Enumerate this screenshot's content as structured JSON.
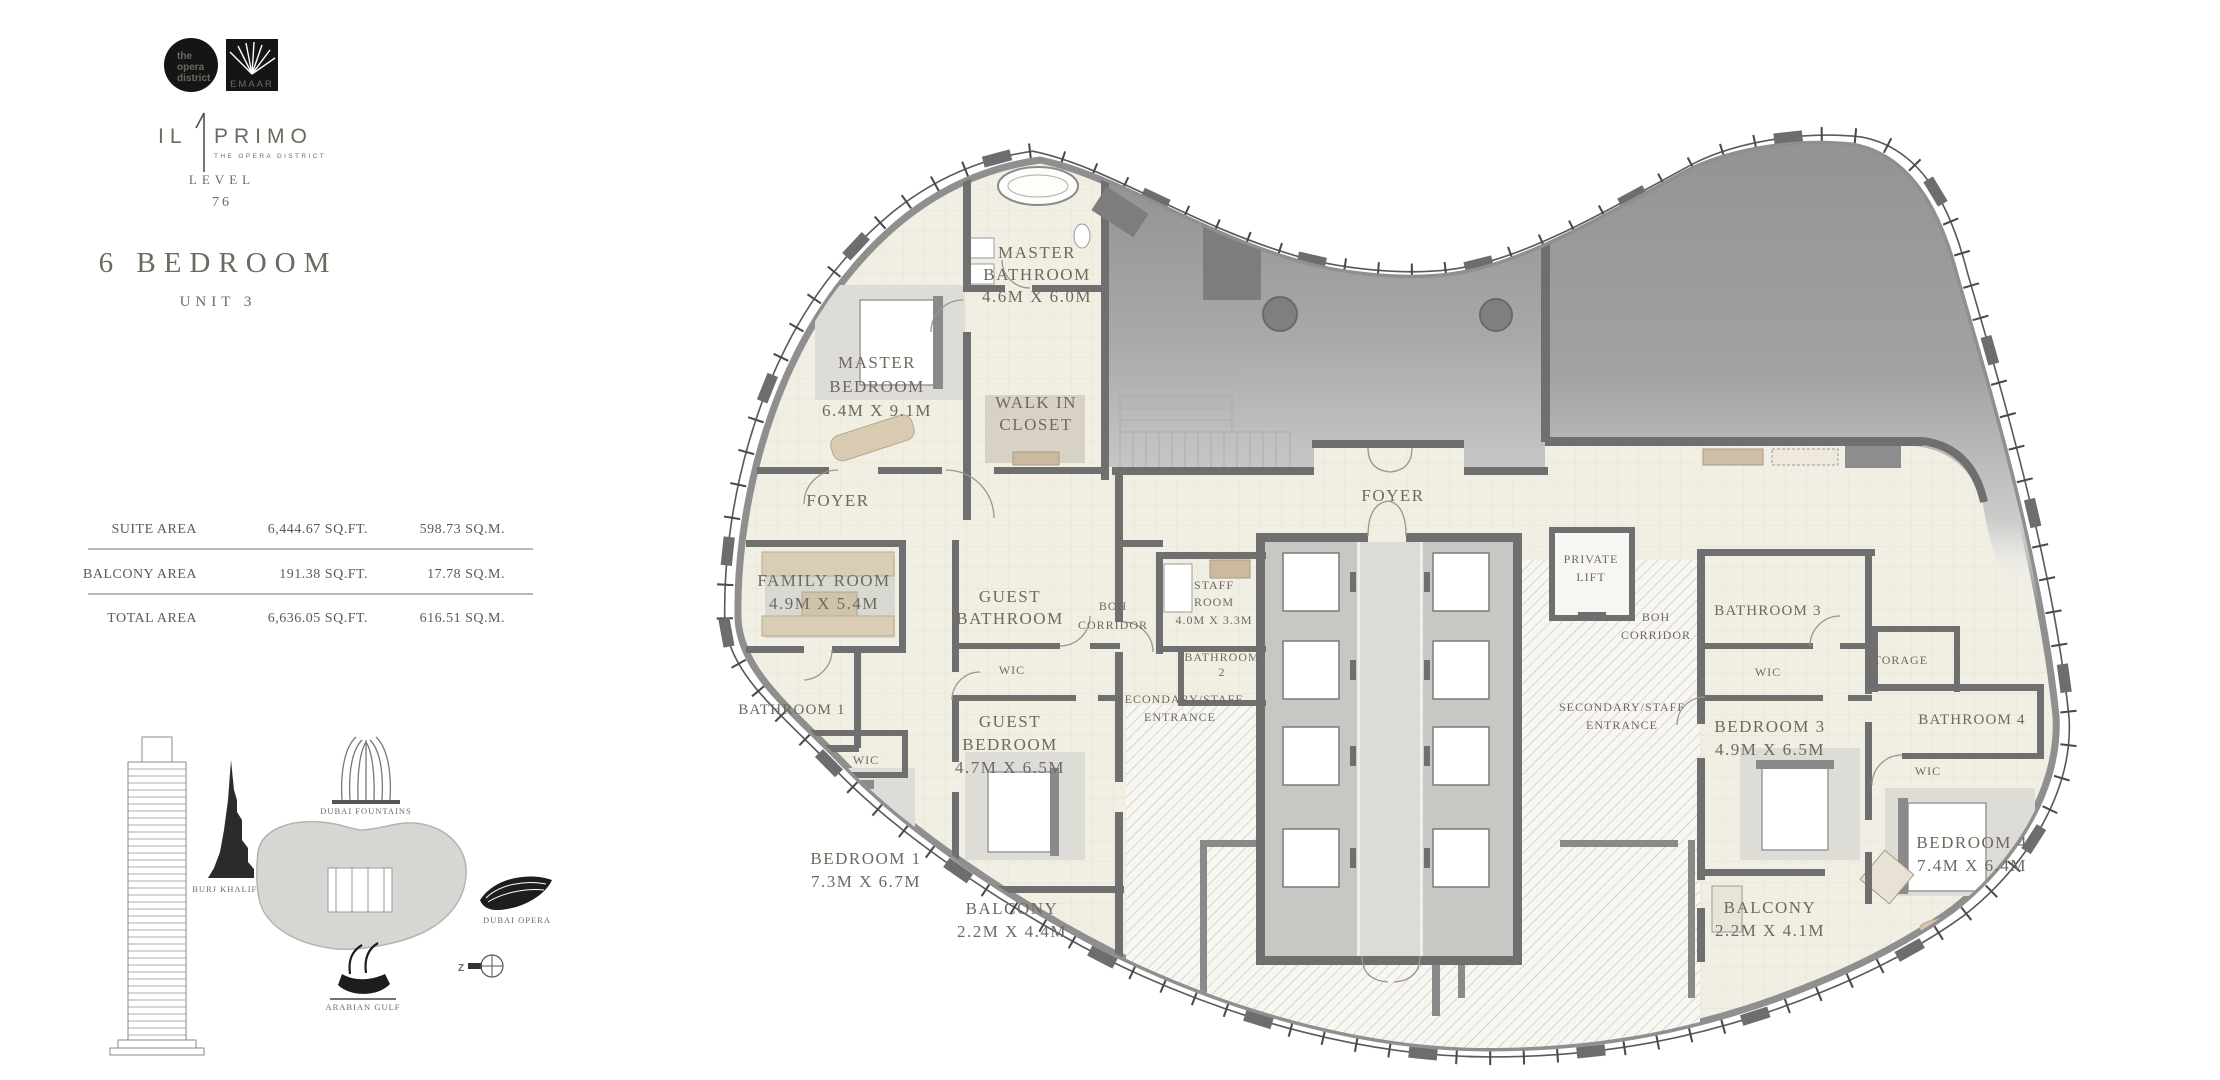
{
  "sidebar": {
    "logos": {
      "opera_district": [
        "the",
        "opera",
        "district"
      ],
      "emaar": "EMAAR"
    },
    "brand": {
      "il": "IL",
      "one": "1",
      "primo": "PRIMO",
      "subtitle": "THE OPERA DISTRICT"
    },
    "level": {
      "label": "LEVEL",
      "value": "76"
    },
    "unit": {
      "type": "6 BEDROOM",
      "number": "UNIT 3"
    },
    "area_table": {
      "rows": [
        {
          "label": "SUITE AREA",
          "sqft": "6,444.67 SQ.FT.",
          "sqm": "598.73 SQ.M."
        },
        {
          "label": "BALCONY AREA",
          "sqft": "191.38 SQ.FT.",
          "sqm": "17.78 SQ.M."
        },
        {
          "label": "TOTAL AREA",
          "sqft": "6,636.05 SQ.FT.",
          "sqm": "616.51 SQ.M."
        }
      ]
    },
    "landmarks": {
      "burj": "BURJ KHALIFA",
      "fountains": "DUBAI FOUNTAINS",
      "opera": "DUBAI OPERA",
      "gulf": "ARABIAN GULF",
      "compass": "Z"
    }
  },
  "floor_plan": {
    "rooms": [
      {
        "lines": [
          "MASTER",
          "BATHROOM",
          "4.6M X 6.0M"
        ]
      },
      {
        "lines": [
          "MASTER",
          "BEDROOM",
          "6.4M X 9.1M"
        ]
      },
      {
        "lines": [
          "WALK IN",
          "CLOSET"
        ]
      },
      {
        "lines": [
          "FOYER"
        ]
      },
      {
        "lines": [
          "FAMILY ROOM",
          "4.9M X 5.4M"
        ]
      },
      {
        "lines": [
          "GUEST",
          "BATHROOM"
        ]
      },
      {
        "lines": [
          "BOH",
          "CORRIDOR"
        ]
      },
      {
        "lines": [
          "BATHROOM 1"
        ]
      },
      {
        "lines": [
          "WIC"
        ]
      },
      {
        "lines": [
          "GUEST",
          "BEDROOM",
          "4.7M X 6.5M"
        ]
      },
      {
        "lines": [
          "WIC"
        ]
      },
      {
        "lines": [
          "BEDROOM 1",
          "7.3M X 6.7M"
        ]
      },
      {
        "lines": [
          "BALCONY",
          "2.2M X 4.4M"
        ]
      },
      {
        "lines": [
          "STAFF",
          "ROOM",
          "4.0M X 3.3M"
        ]
      },
      {
        "lines": [
          "BATHROOM",
          "2"
        ]
      },
      {
        "lines": [
          "SECONDARY/STAFF",
          "ENTRANCE"
        ]
      },
      {
        "lines": [
          "FOYER"
        ]
      },
      {
        "lines": [
          "PRIVATE",
          "LIFT"
        ]
      },
      {
        "lines": [
          "BOH",
          "CORRIDOR"
        ]
      },
      {
        "lines": [
          "SECONDARY/STAFF",
          "ENTRANCE"
        ]
      },
      {
        "lines": [
          "BATHROOM 3"
        ]
      },
      {
        "lines": [
          "WIC"
        ]
      },
      {
        "lines": [
          "STORAGE"
        ]
      },
      {
        "lines": [
          "BEDROOM 3",
          "4.9M X 6.5M"
        ]
      },
      {
        "lines": [
          "BATHROOM 4"
        ]
      },
      {
        "lines": [
          "WIC"
        ]
      },
      {
        "lines": [
          "BEDROOM 4",
          "7.4M X 6.4M"
        ]
      },
      {
        "lines": [
          "BALCONY",
          "2.2M X 4.1M"
        ]
      }
    ]
  },
  "colors": {
    "wall": "#6f6f6f",
    "floor": "#f1eee3",
    "shaded": "#9a9a9a",
    "accent_tan": "#d4c5ab"
  }
}
